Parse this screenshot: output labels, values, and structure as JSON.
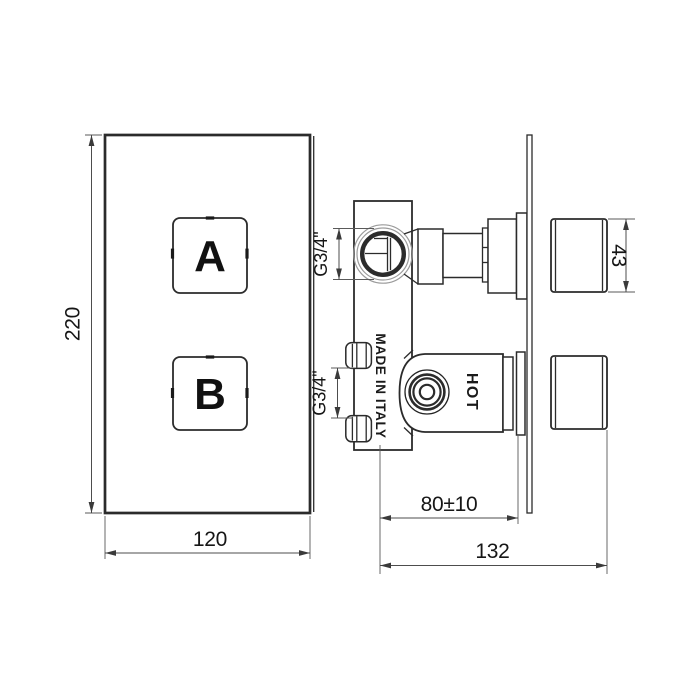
{
  "front_view": {
    "plate_height": "220",
    "plate_width": "120",
    "button_a": "A",
    "button_b": "B"
  },
  "side_view": {
    "top_port_thread": "G3/4\"",
    "bottom_port_thread": "G3/4\"",
    "handle_size": "43",
    "mount_depth": "80±10",
    "overall_depth": "132",
    "made_in": "MADE IN ITALY",
    "hot": "HOT"
  },
  "colors": {
    "line": "#2b2b2b",
    "dim_line": "#4d4d4d",
    "light_line": "#9b9b9b",
    "text": "#161616",
    "background": "#ffffff"
  }
}
